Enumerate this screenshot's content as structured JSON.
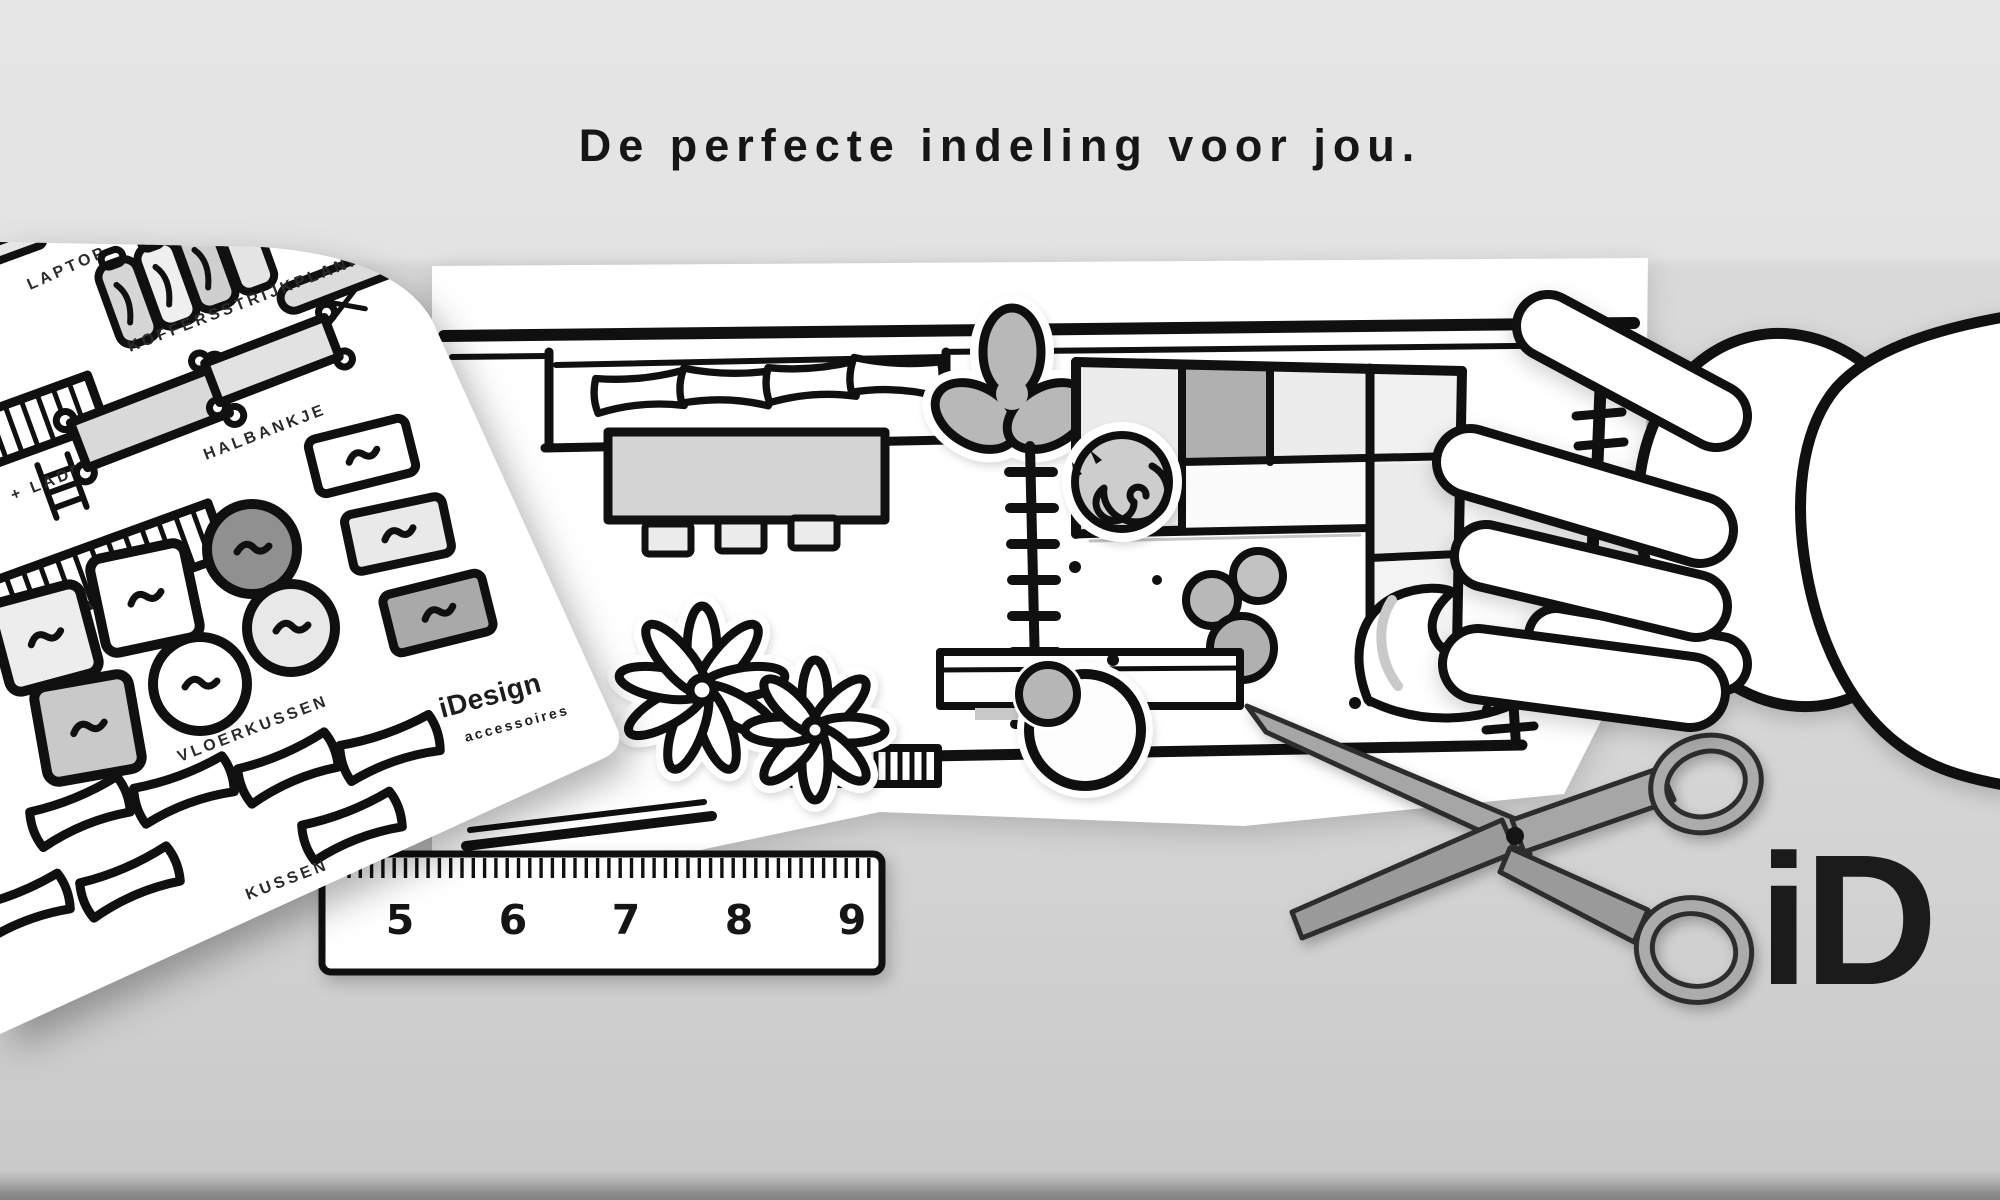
{
  "banner": {
    "title": "De perfecte indeling voor jou."
  },
  "sheet": {
    "brand": "iDesign",
    "brand_tagline": "accessoires",
    "labels": {
      "laptop": "LAPTOP",
      "koffers": "KOFFERS",
      "strijkplank": "STRIJKPLANK",
      "kast_ladder": "KAST + LADDER",
      "boekenkast": "BOEKENKAST",
      "halbankje": "HALBANKJE",
      "vloerkussen": "VLOERKUSSEN",
      "kussen": "KUSSEN"
    }
  },
  "ruler": {
    "numbers": [
      "5",
      "6",
      "7",
      "8",
      "9"
    ]
  },
  "logo": {
    "text": "iD"
  },
  "floorplan_icons": [
    "dining-sofa",
    "sofa-pillows",
    "dining-table",
    "chairs",
    "ceiling-fan",
    "room-divider",
    "sectional-sofa",
    "sleeping-cat",
    "poufs",
    "beanbag",
    "floor-plants",
    "sideboard",
    "wall-bench",
    "wall-radiator",
    "peeled-corner",
    "scissors",
    "hand",
    "ruler"
  ],
  "colors": {
    "ink": "#101010",
    "paper": "#ffffff",
    "bg_top": "#e4e4e4",
    "bg_main": "#d8d8d8",
    "gray_light": "#ececec",
    "gray_mid": "#c6c6c6",
    "gray_dark": "#8f8f8f",
    "scissors_gray": "#a2a2a2"
  }
}
